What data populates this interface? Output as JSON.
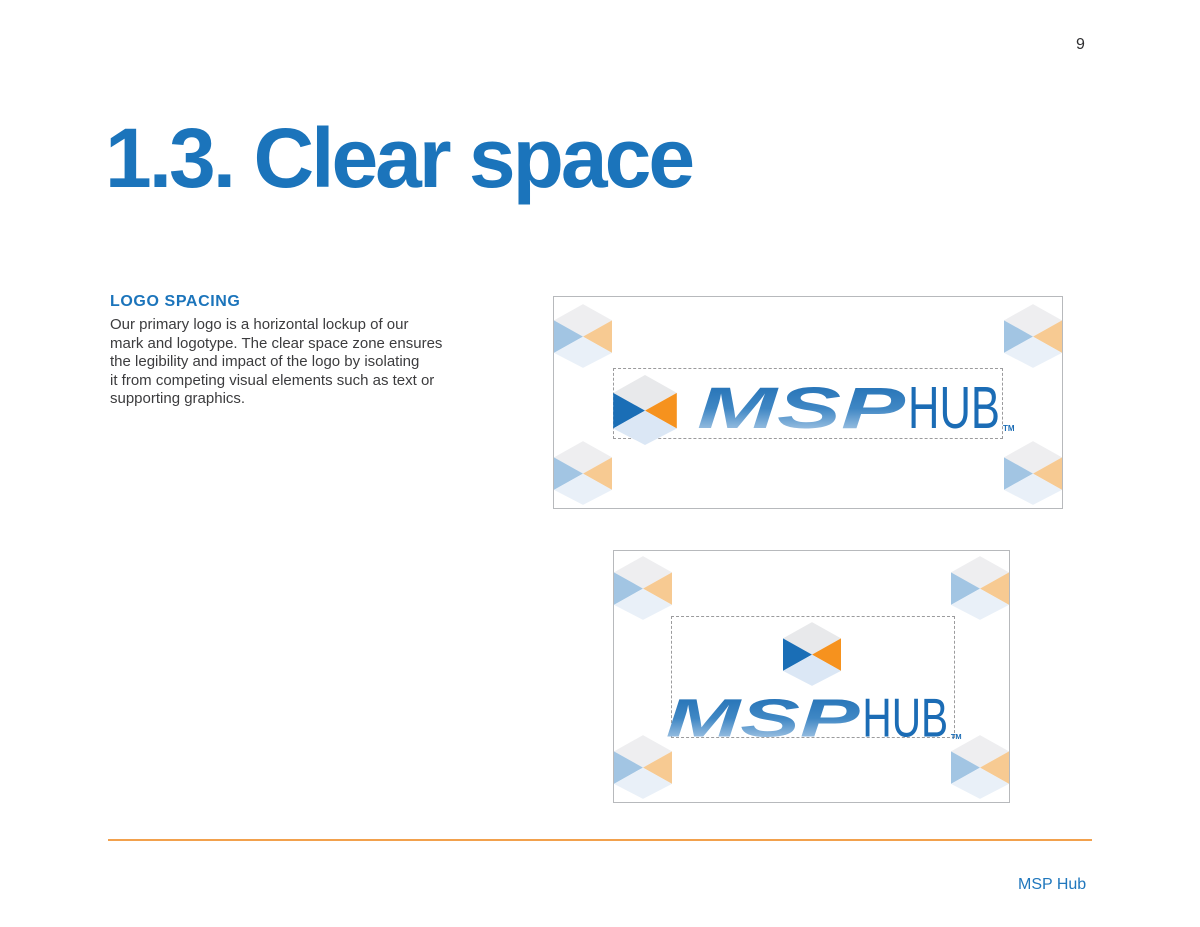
{
  "page": {
    "number": "9"
  },
  "heading": {
    "title": "1.3. Clear space"
  },
  "section": {
    "label": "LOGO SPACING",
    "body_lines": [
      "Our primary logo is a horizontal lockup of our",
      "mark and logotype. The clear space zone ensures",
      "the legibility and impact of the logo by isolating",
      "it from competing visual elements such as text or",
      "supporting graphics."
    ]
  },
  "logo": {
    "wordmark_primary": "MSP",
    "wordmark_secondary": "HUB",
    "trademark_symbol": "TM",
    "colors": {
      "mark": {
        "top": "#e8e9eb",
        "left": "#1a6eb6",
        "right": "#f6921e",
        "bottom": "#dbe7f5"
      },
      "marker": {
        "top": "#eeeef0",
        "left": "#a2c5e3",
        "right": "#f7ca92",
        "bottom": "#e9f0f8"
      },
      "wordmark_gradient": {
        "top": "#1d6cb2",
        "mid": "#3f87c4",
        "bottom": "#c8dcf0"
      },
      "wordmark_secondary_color": "#1b6cb5"
    }
  },
  "footer": {
    "brand": "MSP Hub",
    "rule_color": "#f2a14d",
    "brand_color": "#2077bd"
  }
}
